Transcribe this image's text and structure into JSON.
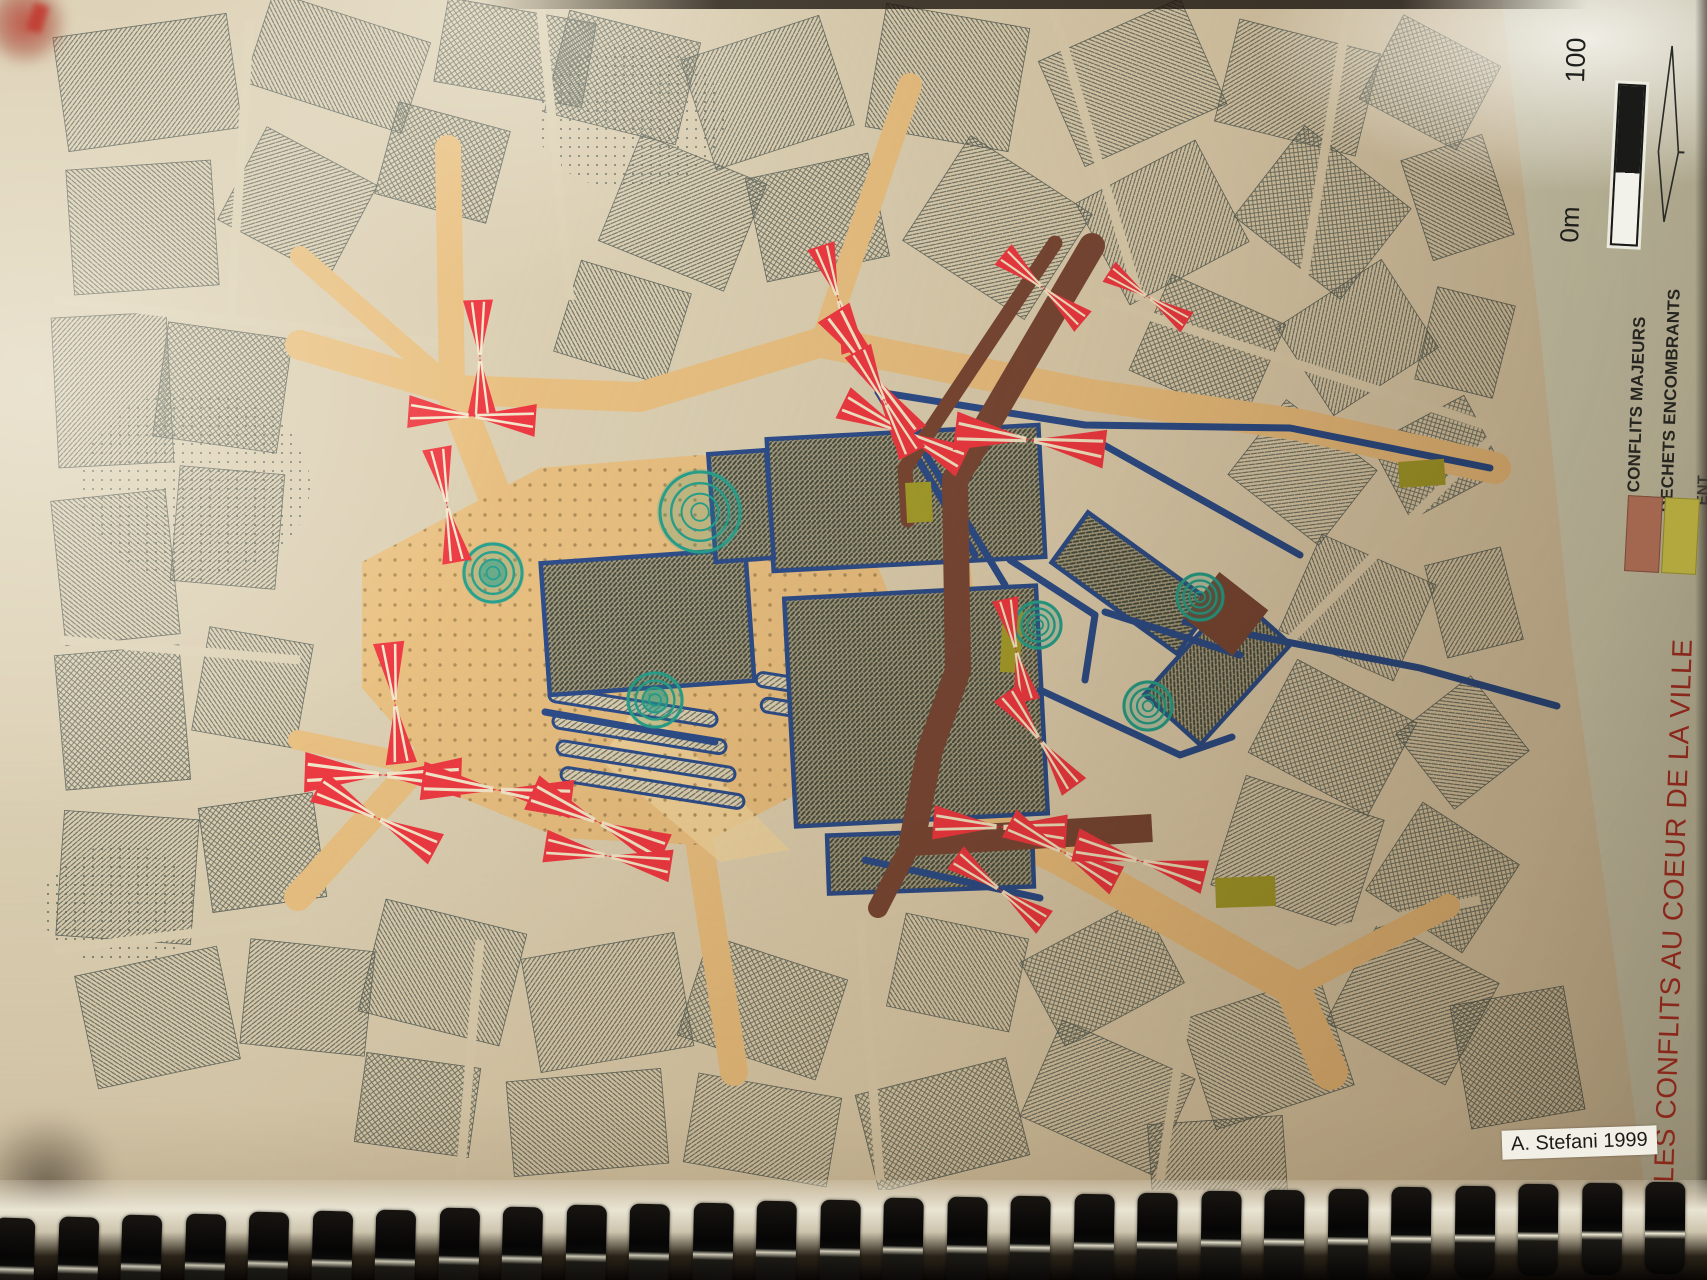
{
  "page": {
    "title": "LES CONFLITS AU COEUR DE LA VILLE",
    "credit": "A. Stefani 1999"
  },
  "legend": {
    "items": [
      {
        "label": "CONFLITS MAJEURS",
        "swatch_color": "#a3674f"
      },
      {
        "label": "DECHETS ENCOMBRANTS",
        "swatch_color": "#b3a83e"
      },
      {
        "label": "ENT"
      }
    ],
    "scale_bar": {
      "start_label": "0m",
      "end_label": "100"
    }
  },
  "map_colors": {
    "pedestrian_zone": "#e9c183",
    "conflict_red": "#ee3a43",
    "route_maroon": "#7a4936",
    "barrier_blue": "#2e4e8e",
    "waste_olive": "#a5a02c",
    "vegetation_teal": "#28a28f",
    "title_red": "#8a271b"
  }
}
